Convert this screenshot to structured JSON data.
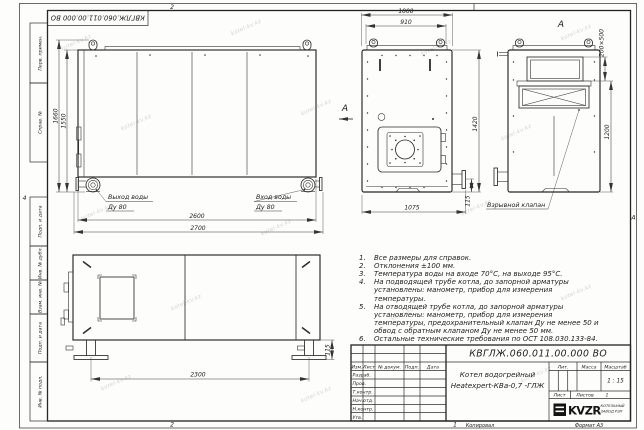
{
  "watermark": "kotel-kv.kz",
  "sheet": {
    "doc_box_top": "КВГЛЖ.060.011.00.000 ВО",
    "margin": {
      "perv_primen": "Перв. примен.",
      "sprav_no": "Справ. №",
      "podp_data_1": "Подп. и дата",
      "inv_dubl": "Инв. № дубл.",
      "vzam_inv": "Взам. инв. №",
      "podp_data_2": "Подп. и дата",
      "inv_podl": "Инв. № подл.",
      "zone_left": "4",
      "zone_right": "А",
      "zone_top": "2",
      "zone_bottom": "2",
      "zone_bottom_right": "1"
    },
    "footer": {
      "copied": "Копировал",
      "format": "Формат А3"
    }
  },
  "views": {
    "side": {
      "dim_height_total": "1660",
      "dim_height_body": "1550",
      "dim_length_body": "2600",
      "dim_length_total": "2700",
      "outlet_label": "Выход воды",
      "outlet_dn": "Ду 80",
      "inlet_label": "Вход воды",
      "inlet_dn": "Ду 80"
    },
    "front": {
      "dim_width_total": "1000",
      "dim_width_inner": "910",
      "dim_height": "1420",
      "dim_width_bottom": "1075",
      "dim_flange_offset": "115",
      "view_arrow_label": "А"
    },
    "rear": {
      "view_label": "А",
      "dim_opening": "200×500",
      "dim_height": "1200",
      "callout_explosion_valve": "Взрывной клапан"
    },
    "plan": {
      "dim_support_span": "2300",
      "dim_support_height": "115"
    }
  },
  "notes": {
    "items": [
      {
        "n": "1.",
        "t": "Все размеры для справок."
      },
      {
        "n": "2.",
        "t": "Отклонения ±100 мм."
      },
      {
        "n": "3.",
        "t": "Температура воды на входе 70°С, на выходе 95°С."
      },
      {
        "n": "4.",
        "t": "На подводящей трубе котла, до запорной арматуры установлены: манометр, прибор для измерения температуры."
      },
      {
        "n": "5.",
        "t": "На отводящей трубе котла, до запорной арматуры установлены: манометр, прибор для измерения температуры, предохранительный клапан Ду не менее 50 и обвод с обратным клапаном Ду не менее 50 мм."
      },
      {
        "n": "6.",
        "t": "Остальные технические требования по ОСТ 108.030.133-84."
      }
    ]
  },
  "title_block": {
    "doc_number": "КВГЛЖ.060.011.00.000 ВО",
    "product_name_line1": "Котел водогрейный",
    "product_name_line2": "Heatexpert-КВа-0,7 -ГЛЖ",
    "col_izm": "Изм.",
    "col_list": "Лист",
    "col_doc": "№ докум.",
    "col_podp": "Подп.",
    "col_data": "Дата",
    "row_razrab": "Разраб.",
    "row_prov": "Пров.",
    "row_tkontr": "Т.контр.",
    "row_nachotd": "Нач.отд.",
    "row_nkontr": "Н.контр.",
    "row_utv": "Утв.",
    "lit_label": "Лит.",
    "mass_label": "Масса",
    "scale_label": "Масштаб",
    "scale_value": "1 : 15",
    "sheet_label": "Лист",
    "sheets_label": "Листов",
    "sheets_value": "1",
    "logo_text": "KVZR",
    "company_line1": "КОТЕЛЬНЫЙ",
    "company_line2": "ЗАВОД РЭП"
  }
}
